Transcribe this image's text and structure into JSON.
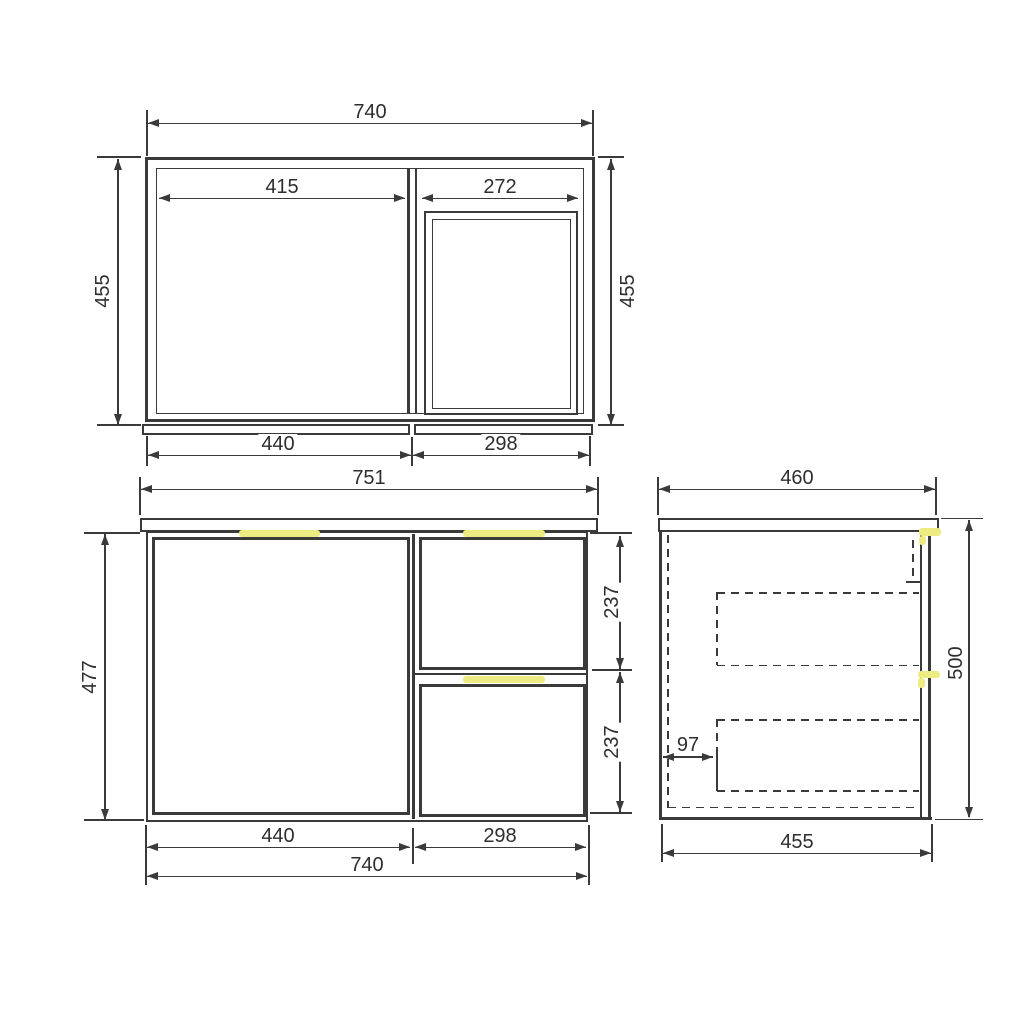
{
  "colors": {
    "line": "#3a3a3a",
    "handle_accent": "#ecec83",
    "background": "#ffffff"
  },
  "top_view": {
    "overall_width": "740",
    "left_opening_width": "415",
    "right_opening_width": "272",
    "depth_left": "455",
    "depth_right": "455",
    "door_section_width": "440",
    "drawer_section_width": "298"
  },
  "front_view": {
    "top_panel_width": "751",
    "body_height": "477",
    "top_drawer_height": "237",
    "bottom_drawer_height": "237",
    "door_section_width": "440",
    "drawer_section_width": "298",
    "overall_width": "740"
  },
  "side_view": {
    "top_depth": "460",
    "overall_height": "500",
    "drawer_back_offset": "97",
    "body_depth": "455"
  }
}
